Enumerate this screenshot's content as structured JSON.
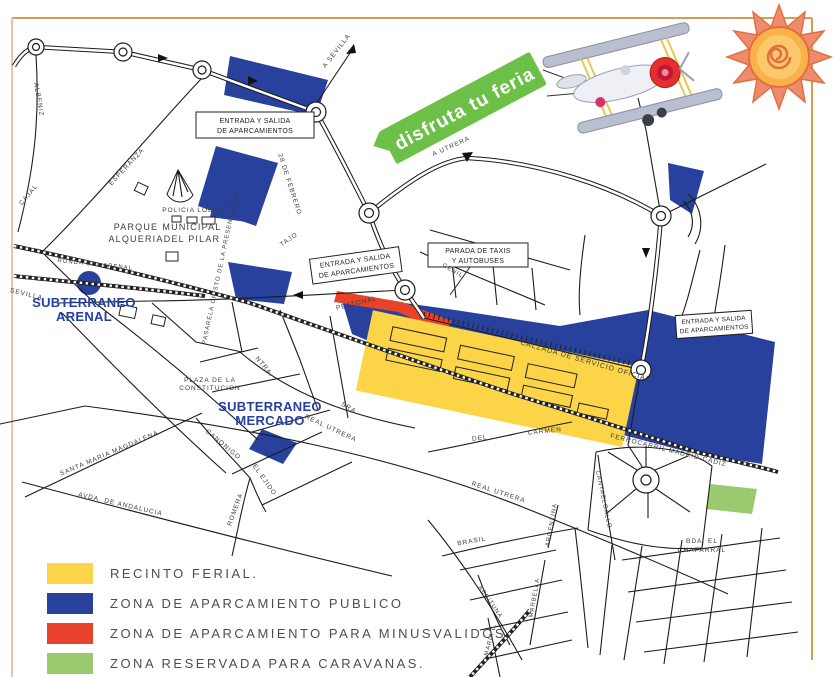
{
  "banner": {
    "text": "disfruta tu feria"
  },
  "legend": {
    "items": [
      {
        "label": "RECINTO FERIAL.",
        "color": "#fbd448"
      },
      {
        "label": "ZONA DE APARCAMIENTO PUBLICO",
        "color": "#27419c"
      },
      {
        "label": "ZONA DE APARCAMIENTO PARA MINUSVALIDOS.",
        "color": "#e8432a"
      },
      {
        "label": "ZONA RESERVADA PARA CARAVANAS.",
        "color": "#9bc96d"
      }
    ]
  },
  "colors": {
    "recinto": "#fbd448",
    "parking_blue": "#27419c",
    "minusvalidos_red": "#e8432a",
    "caravanas_green": "#9bc96d",
    "banner_green": "#6cbf47",
    "landmark_blue": "#2640a0"
  },
  "signs": {
    "entrada_line1": "ENTRADA Y SALIDA",
    "entrada_line2": "DE APARCAMIENTOS",
    "taxi_line1": "PARADA DE TAXIS",
    "taxi_line2": "Y AUTOBUSES"
  },
  "landmarks": {
    "arenal_line1": "SUBTERRANEO",
    "arenal_line2": "ARENAL",
    "mercado_line1": "SUBTERRANEO",
    "mercado_line2": "MERCADO",
    "parque_line1": "PARQUE",
    "parque_line2": "ALQUERIA",
    "municipal_line1": "MUNICIPAL",
    "municipal_line2": "DEL PILAR",
    "policia": "POLICIA LOCAL",
    "plaza_line1": "PLAZA DE LA",
    "plaza_line2": "CONSTITUCION",
    "bda_line1": "BDA. EL",
    "bda_line2": "CHAPARRAL"
  },
  "directions": {
    "sevilla": "A SEVILLA",
    "utrera": "A UTRERA"
  },
  "streets": {
    "albeniz": "ALBENIZ",
    "esperanza": "ESPERANZA",
    "cajal": "CAJAL",
    "febrero": "28 DE FEBRERO",
    "tajo": "TAJO",
    "ronda_arenal": "RONDA DEL ARENAL",
    "sevilla": "SEVILLA",
    "pasarela": "PASARELA CRISTO DE LA PRESENTACION",
    "peatonal": "PEATONAL",
    "genil": "GENIL",
    "calzada": "CALZADA DE SERVICIO OFICIAL",
    "ntra": "NTRA.",
    "sra": "SRA.",
    "real_utrera": "REAL UTRERA",
    "real_utrera_2": "REAL UTRERA",
    "del": "DEL",
    "carmen": "CARMEN",
    "canonigo": "CANONIGO",
    "santa_maria_magdalena": "SANTA MARIA MAGDALENA",
    "avda_andalucia": "AVDA. DE ANDALUCIA",
    "el_ejido": "EL EJIDO",
    "romera": "ROMERA",
    "ferrocarril": "FERROCARRIL MADRID-CADIZ",
    "cantaelgallo": "CANTAELGALLO",
    "brasil": "BRASIL",
    "marbella": "MARBELLA",
    "aceituna": "ACEITUNA",
    "argentina": "ARGENTINA",
    "maria_l": "MARIA L."
  }
}
